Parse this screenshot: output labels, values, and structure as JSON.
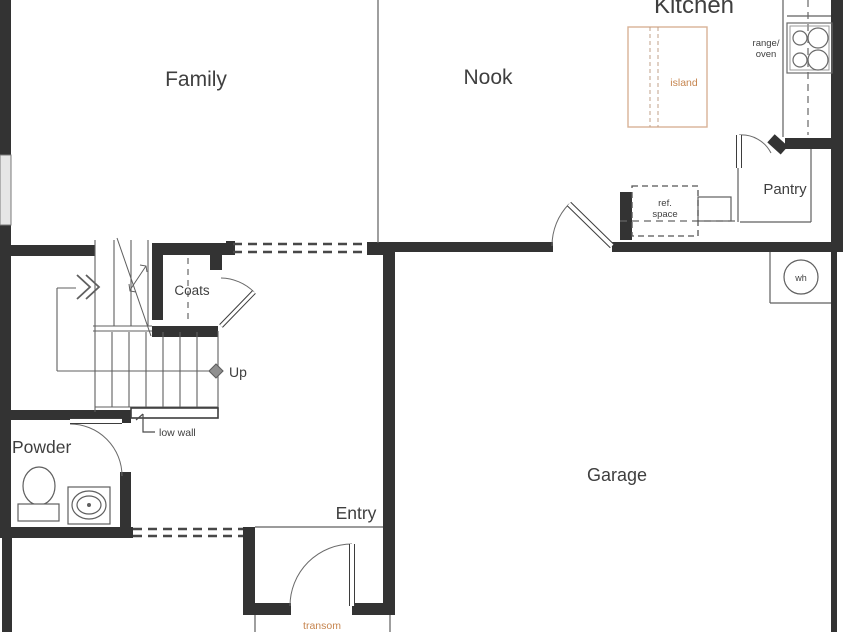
{
  "plan_title": "First floor plan",
  "colors": {
    "wall": "#333333",
    "thin_line": "#5f5f5f",
    "accent_orange": "#c6854f",
    "accent_outline": "#d9b296",
    "window_fill": "#e6e6e6"
  },
  "rooms": {
    "kitchen": "Kitchen",
    "family": "Family",
    "nook": "Nook",
    "pantry": "Pantry",
    "coats": "Coats",
    "powder": "Powder",
    "entry": "Entry",
    "garage": "Garage"
  },
  "annotations": {
    "island": "island",
    "range_line1": "range/",
    "range_line2": "oven",
    "ref_line1": "ref.",
    "ref_line2": "space",
    "water_heater": "wh",
    "up": "Up",
    "low_wall": "low wall",
    "transom": "transom"
  }
}
